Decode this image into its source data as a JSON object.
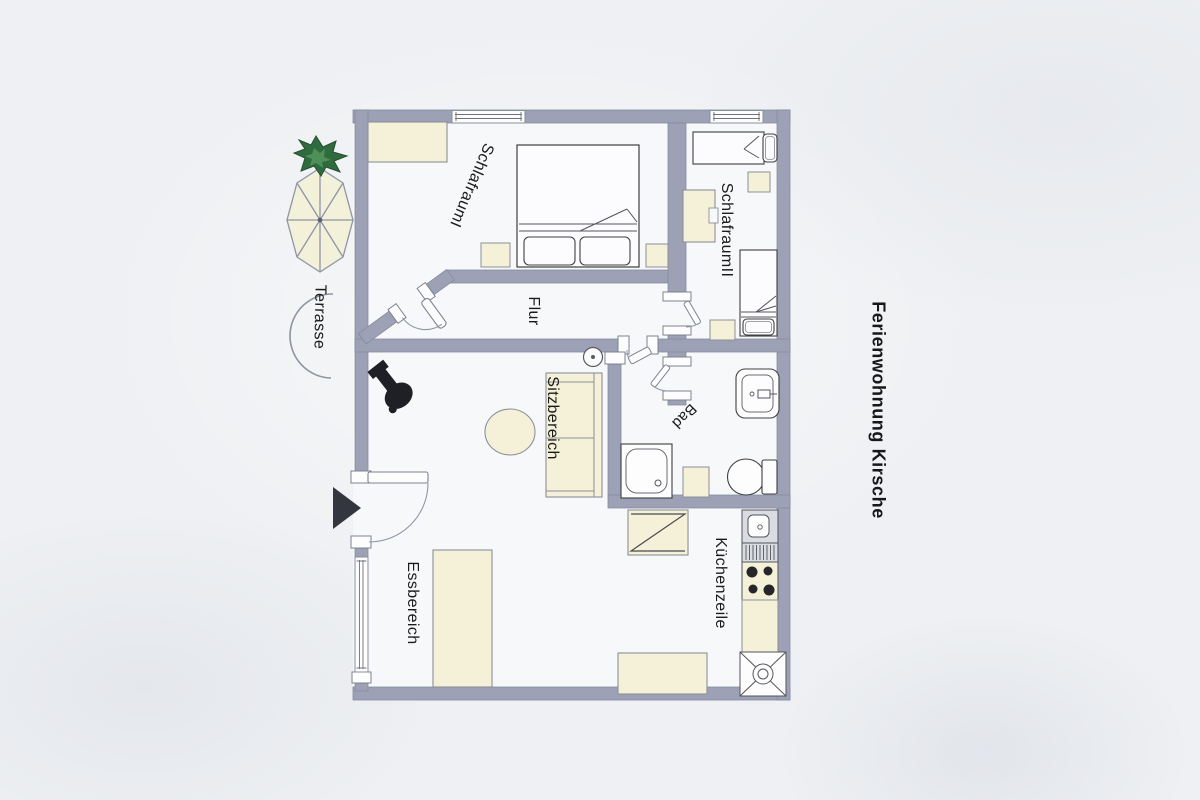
{
  "title": "Ferienwohnung Kirsche",
  "labels": {
    "terrasse": "Terrasse",
    "schlafraum1": "SchlafraumI",
    "schlafraum2": "SchlafraumII",
    "flur": "Flur",
    "sitzbereich": "Sitzbereich",
    "bad": "Bad",
    "essbereich": "Essbereich",
    "kuechenzeile": "Küchenzeile"
  },
  "colors": {
    "wall": "#9ca1b5",
    "wall_edge": "#868ca0",
    "floor": "#f7f8fa",
    "furniture_fill": "#f4f1d8",
    "furniture_edge": "#8c9099",
    "fixture_edge": "#3f3f3f",
    "black_item": "#1e2025",
    "plant_green_dark": "#2f6b3e",
    "plant_green_light": "#4f8f58",
    "sink_unit_gray": "#d9dce2",
    "background": "#eef0f3",
    "text": "#1b1b1b"
  },
  "symbols": [
    "parasol",
    "potted-plant",
    "terrace-arc",
    "entrance-arrow",
    "double-bed",
    "single-bed",
    "pillow",
    "wardrobe",
    "nightstand",
    "wood-stove",
    "sofa",
    "round-table",
    "ceiling-lamp",
    "shower",
    "washbasin",
    "toilet",
    "bath-cabinet",
    "kitchen-sink",
    "drainer",
    "hob",
    "counter",
    "corner-carousel",
    "dining-table",
    "bench",
    "door-swing",
    "window"
  ]
}
